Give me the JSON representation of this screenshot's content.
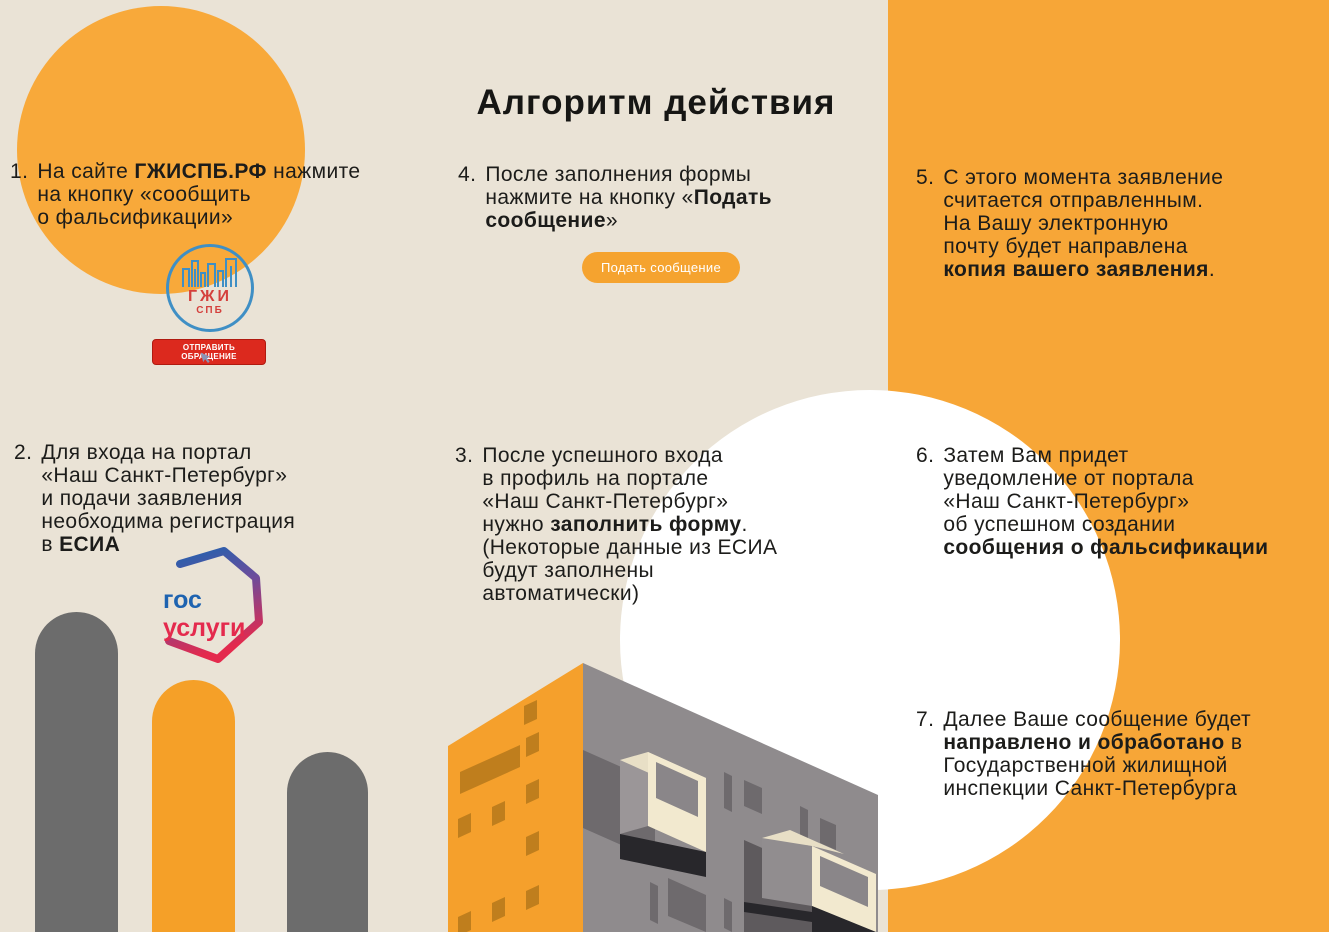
{
  "title": "Алгоритм действия",
  "steps": [
    {
      "num": "1.",
      "text": "На сайте **ГЖИСПБ.РФ** нажмите\nна кнопку «сообщить\nо фальсификации»"
    },
    {
      "num": "2.",
      "text": "Для входа на портал\n«Наш Санкт-Петербург»\nи подачи заявления\nнеобходима регистрация\nв **ЕСИА**"
    },
    {
      "num": "3.",
      "text": "После успешного входа\nв профиль на портале\n«Наш Санкт-Петербург»\nнужно **заполнить форму**.\n(Некоторые данные из ЕСИА\nбудут заполнены\nавтоматически)"
    },
    {
      "num": "4.",
      "text": "После заполнения формы\nнажмите на кнопку «**Подать**\n**сообщение**»"
    },
    {
      "num": "5.",
      "text": "С этого момента заявление\nсчитается отправленным.\nНа Вашу электронную\nпочту будет направлена\n**копия вашего заявления**."
    },
    {
      "num": "6.",
      "text": "Затем Вам придет\nуведомление от портала\n«Наш Санкт-Петербург»\nоб успешном создании\n**сообщения о фальсификации**"
    },
    {
      "num": "7.",
      "text": "Далее Ваше сообщение будет\n**направлено и обработано** в\nГосударственной жилищной\nинспекции Санкт-Петербурга"
    }
  ],
  "gzhi_logo": {
    "title": "ГЖИ",
    "subtitle": "СПБ",
    "button_label": "ОТПРАВИТЬ ОБРАЩЕНИЕ"
  },
  "gosuslugi_logo": {
    "line1": "гос",
    "line2": "услуги"
  },
  "submit_button_label": "Подать сообщение",
  "colors": {
    "background": "#EAE3D6",
    "accent_orange": "#F7A637",
    "text_dark": "#1C1C1A",
    "white_circle": "#FFFFFF",
    "button_red": "#DC291E",
    "gzhi_blue": "#3F8FC5",
    "gzhi_red": "#D4403C",
    "gosuslugi_blue": "#1E63B0",
    "gosuslugi_red": "#E42A4D",
    "bar_gray": "#6C6C6C"
  }
}
